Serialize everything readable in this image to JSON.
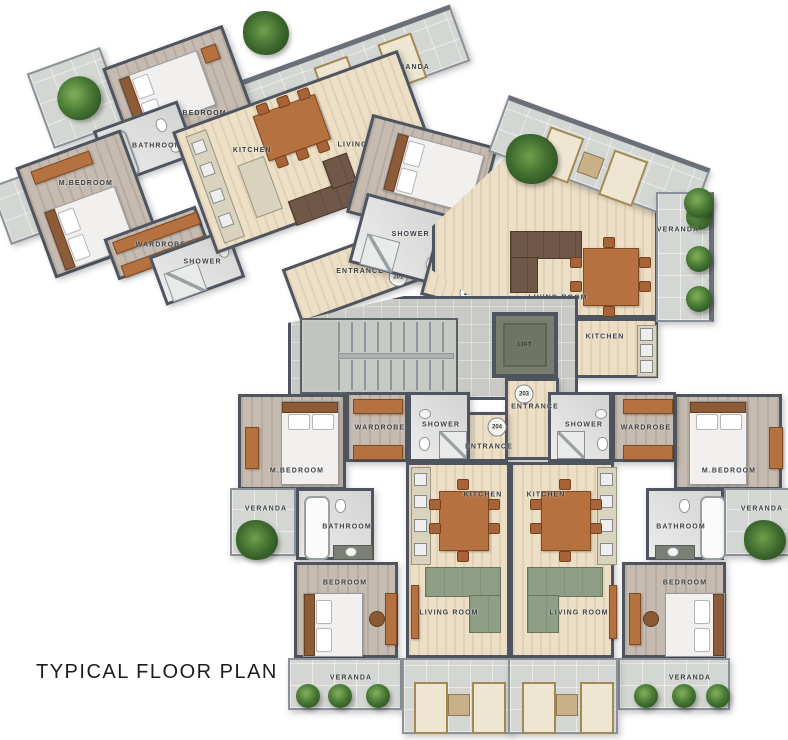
{
  "title": "TYPICAL FLOOR PLAN",
  "labels": {
    "bedroom": "BEDROOM",
    "m_bedroom": "M.BEDROOM",
    "bathroom": "BATHROOM",
    "wardrobe": "WARDROBE",
    "shower": "SHOWER",
    "kitchen": "KITCHEN",
    "living_room": "LIVING ROOM",
    "veranda": "VERANDA",
    "entrance": "ENTRANCE",
    "lift": "LIFT"
  },
  "units": {
    "u201": "201",
    "u202": "202",
    "u203": "203",
    "u204": "204"
  },
  "colors": {
    "wall": "#4e5560",
    "floor_wood": "#ecdfc6",
    "floor_wood_gray": "#c6bbb0",
    "floor_tile": "#d3d6d2",
    "floor_bath": "#e0e0df",
    "floor_hall": "#c9cac5",
    "sofa_green": "#8f9f85",
    "sofa_brown": "#6f5847",
    "furniture_wood": "#b5713f",
    "plant_green": "#3f6b2f"
  }
}
